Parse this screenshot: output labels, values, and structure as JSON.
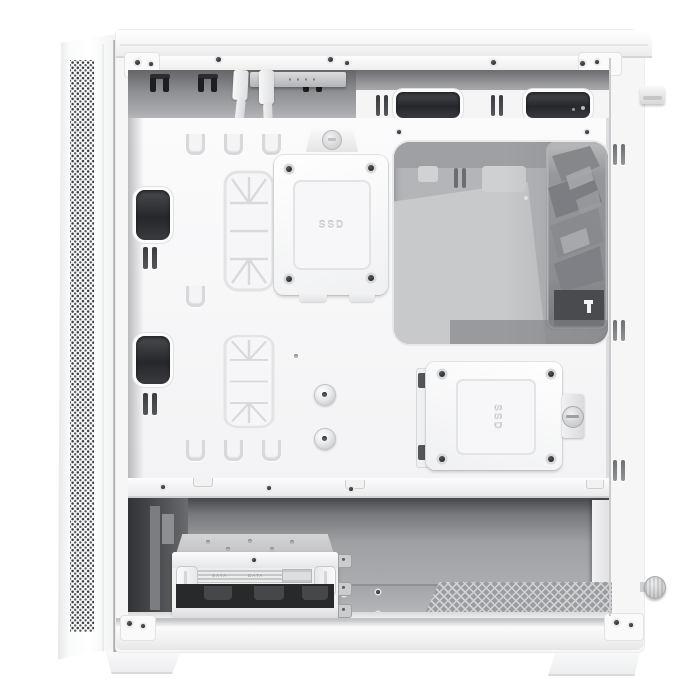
{
  "subject": "White mid-tower PC case with side panel removed, interior cable-management view",
  "palette": {
    "background": "#ffffff",
    "case_white": "#f6f6f7",
    "recess_gray": "#8e8f92",
    "cutout_dark": "#2b2c2f",
    "window_gray": "#b4b5b8",
    "fan_gray": "#83858a",
    "floor_gray": "#aeafb2"
  },
  "labels": {
    "ssd_upper": "SSD",
    "ssd_lower": "SSD",
    "hdd_text_1": "SATA",
    "hdd_text_2": "DATA"
  }
}
